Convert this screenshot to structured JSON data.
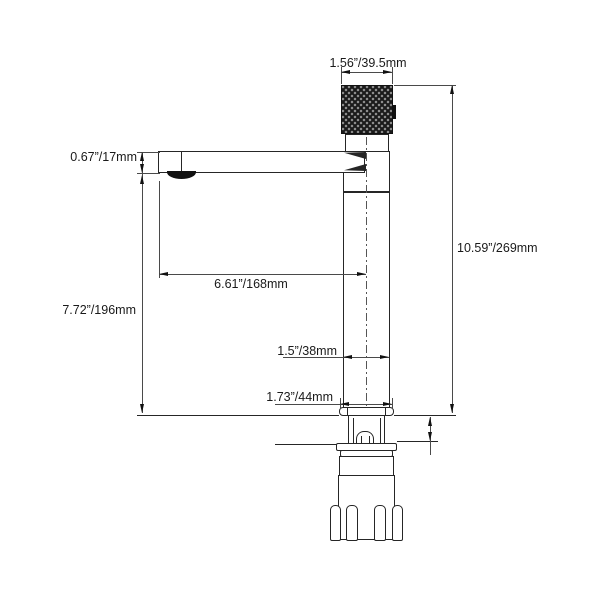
{
  "drawing": {
    "type": "technical-dimension-diagram",
    "subject": "tall vessel-sink faucet, side elevation with mounting hardware",
    "labels": {
      "knob_width": "1.56”/39.5mm",
      "spout_height": "0.67”/17mm",
      "overall_height": "10.59”/269mm",
      "spout_reach": "6.61”/168mm",
      "spout_to_deck": "7.72”/196mm",
      "body_diameter": "1.5”/38mm",
      "base_diameter": "1.73”/44mm"
    },
    "colors": {
      "object_line": "#262626",
      "dimension_line": "#4a4a4a",
      "arrow": "#111111",
      "knob_fill": "#1a1a1a",
      "knurl_dot": "#8f8f8f",
      "text": "#1a1a1a",
      "background": "#ffffff"
    }
  }
}
